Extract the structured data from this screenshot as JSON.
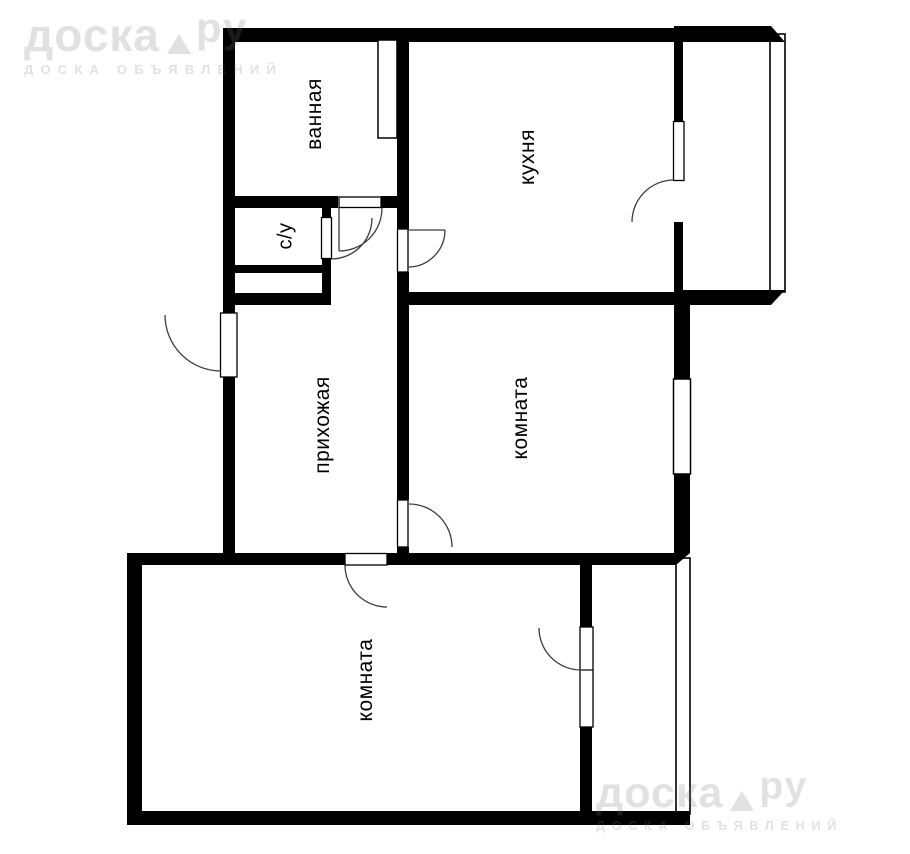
{
  "image_type": "apartment floor plan",
  "watermark": {
    "brand_part1": "доска",
    "brand_part2": "ру",
    "tagline": "ДОСКА ОБЪЯВЛЕНИЙ"
  },
  "rooms": [
    {
      "id": "bathroom",
      "label": "ванная"
    },
    {
      "id": "toilet",
      "label": "с/у"
    },
    {
      "id": "kitchen",
      "label": "кухня"
    },
    {
      "id": "hallway",
      "label": "прихожая"
    },
    {
      "id": "room-middle",
      "label": "комната"
    },
    {
      "id": "room-bottom",
      "label": "комната"
    }
  ],
  "colors": {
    "walls": "#000000",
    "background": "#ffffff",
    "door_lines": "#3c3c3c",
    "watermark_gray": "#e9e9e9"
  }
}
